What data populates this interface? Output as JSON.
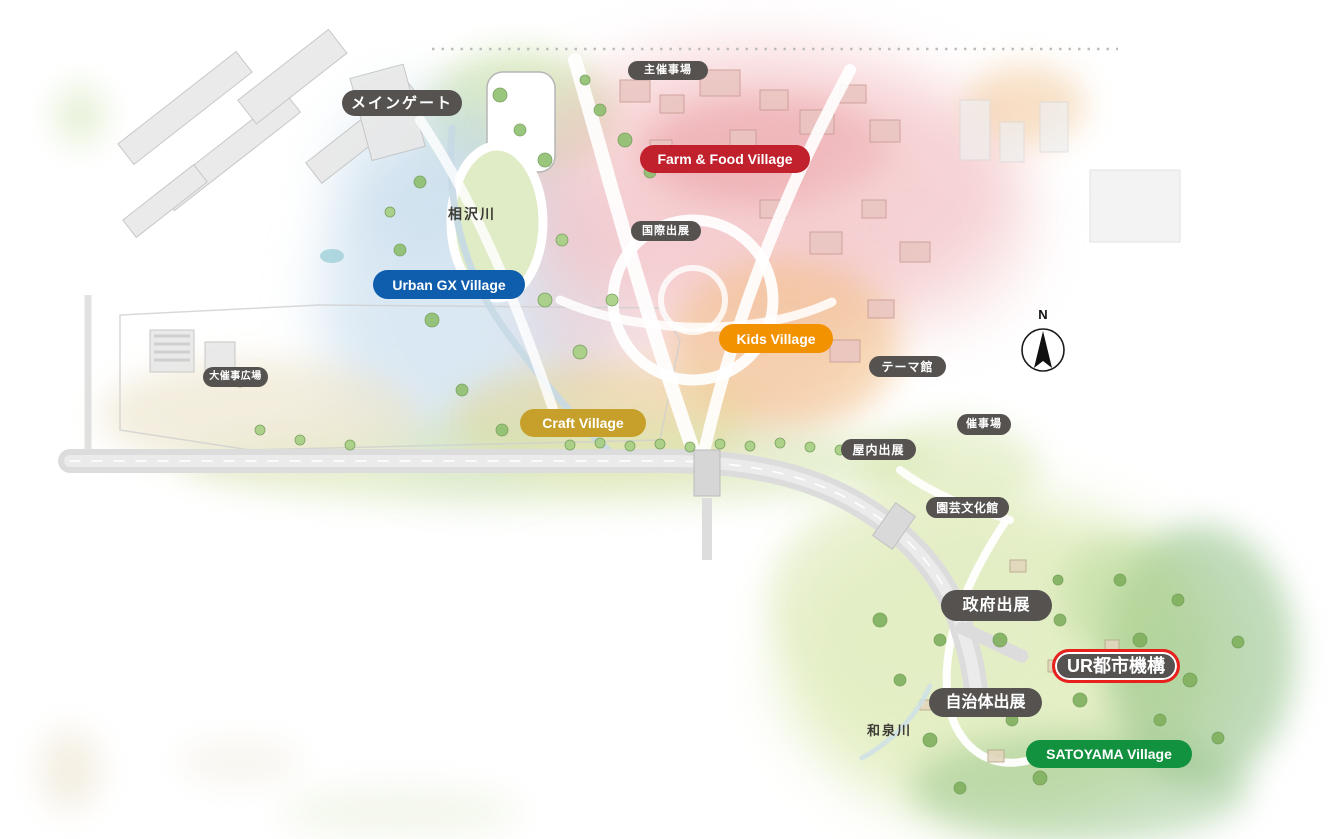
{
  "map": {
    "labels": {
      "main_gate": "メインゲート",
      "main_event_venue": "主催事場",
      "farm_food_village": "Farm & Food Village",
      "international_exhibits": "国際出展",
      "urban_gx_village": "Urban GX Village",
      "kids_village": "Kids Village",
      "theme_pavilion": "テーマ館",
      "grand_event_plaza": "大催事広場",
      "craft_village": "Craft Village",
      "event_venue": "催事場",
      "indoor_exhibits": "屋内出展",
      "horticultural_culture_hall": "園芸文化館",
      "government_exhibits": "政府出展",
      "ur_agency": "UR都市機構",
      "municipal_exhibits": "自治体出展",
      "satoyama_village": "SATOYAMA Village"
    },
    "rivers": {
      "aizawa": "相沢川",
      "izumi": "和泉川"
    },
    "compass": {
      "north": "N"
    },
    "colors": {
      "label_gray": "#555250",
      "farm_food_red": "#c1202d",
      "urban_gx_blue": "#0f5dad",
      "kids_orange": "#f39200",
      "craft_gold": "#c6a02a",
      "satoyama_green": "#12913f",
      "highlight_ring_red": "#e8211d",
      "label_text_white": "#ffffff"
    }
  }
}
